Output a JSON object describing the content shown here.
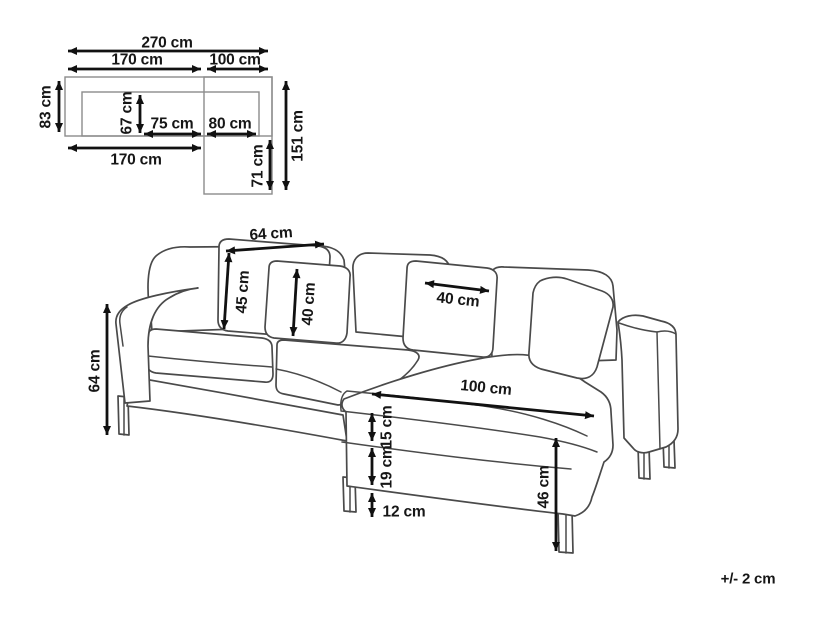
{
  "schematic": {
    "total_width": "270 cm",
    "left_section_width": "170 cm",
    "right_section_width": "100 cm",
    "body_depth": "83 cm",
    "seat_depth": "67 cm",
    "left_seat_width": "75 cm",
    "right_seat_width": "80 cm",
    "left_section_width_bottom": "170 cm",
    "chaise_extension_depth": "71 cm",
    "chaise_total_depth": "151 cm"
  },
  "sofa": {
    "back_cushion_width": "64 cm",
    "back_cushion_height": "45 cm",
    "small_back_cushion_height": "40 cm",
    "chaise_back_cushion_width": "40 cm",
    "overall_height": "64 cm",
    "chaise_length": "100 cm",
    "seat_cushion_thickness": "15 cm",
    "base_height": "19 cm",
    "leg_height": "12 cm",
    "seat_height": "46 cm"
  },
  "tolerance_note": "+/- 2 cm"
}
